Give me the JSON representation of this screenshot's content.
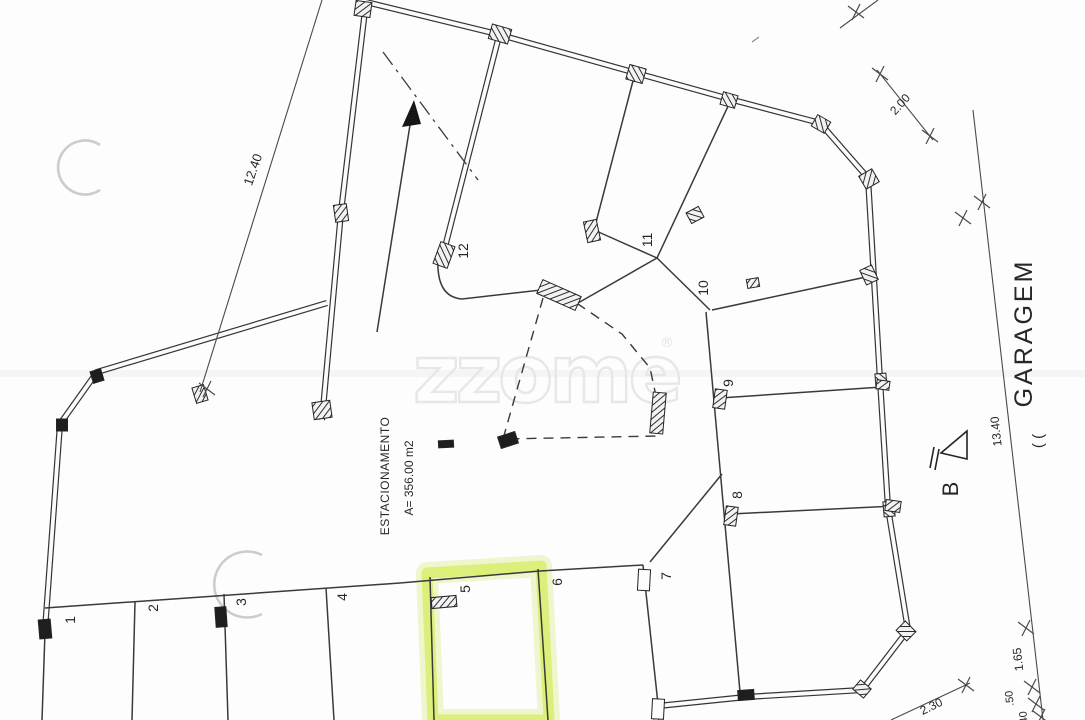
{
  "watermark": {
    "text": "zzome",
    "registered_mark": "®"
  },
  "plan": {
    "area_label": {
      "line1": "ESTACIONAMENTO",
      "line2": "A= 356.00 m2"
    },
    "side_text": {
      "main": "GARAGEM",
      "partial": "( ("
    },
    "section_marker": {
      "label": "B"
    },
    "spaces": {
      "s1": "1",
      "s2": "2",
      "s3": "3",
      "s4": "4",
      "s5": "5",
      "s6": "6",
      "s7": "7",
      "s8": "8",
      "s9": "9",
      "s10": "10",
      "s11": "11",
      "s12": "12"
    },
    "dimensions": {
      "left_ramp": "12.40",
      "top_right": "2.00",
      "right_long": "13.40",
      "right_seg_a": "1.65",
      "right_seg_b": ".50",
      "right_seg_c": "40",
      "bottom_right": "2.30"
    },
    "colors": {
      "highlight": "#d7ee66",
      "ink": "#343434",
      "watermark": "#e7e7e7"
    }
  }
}
